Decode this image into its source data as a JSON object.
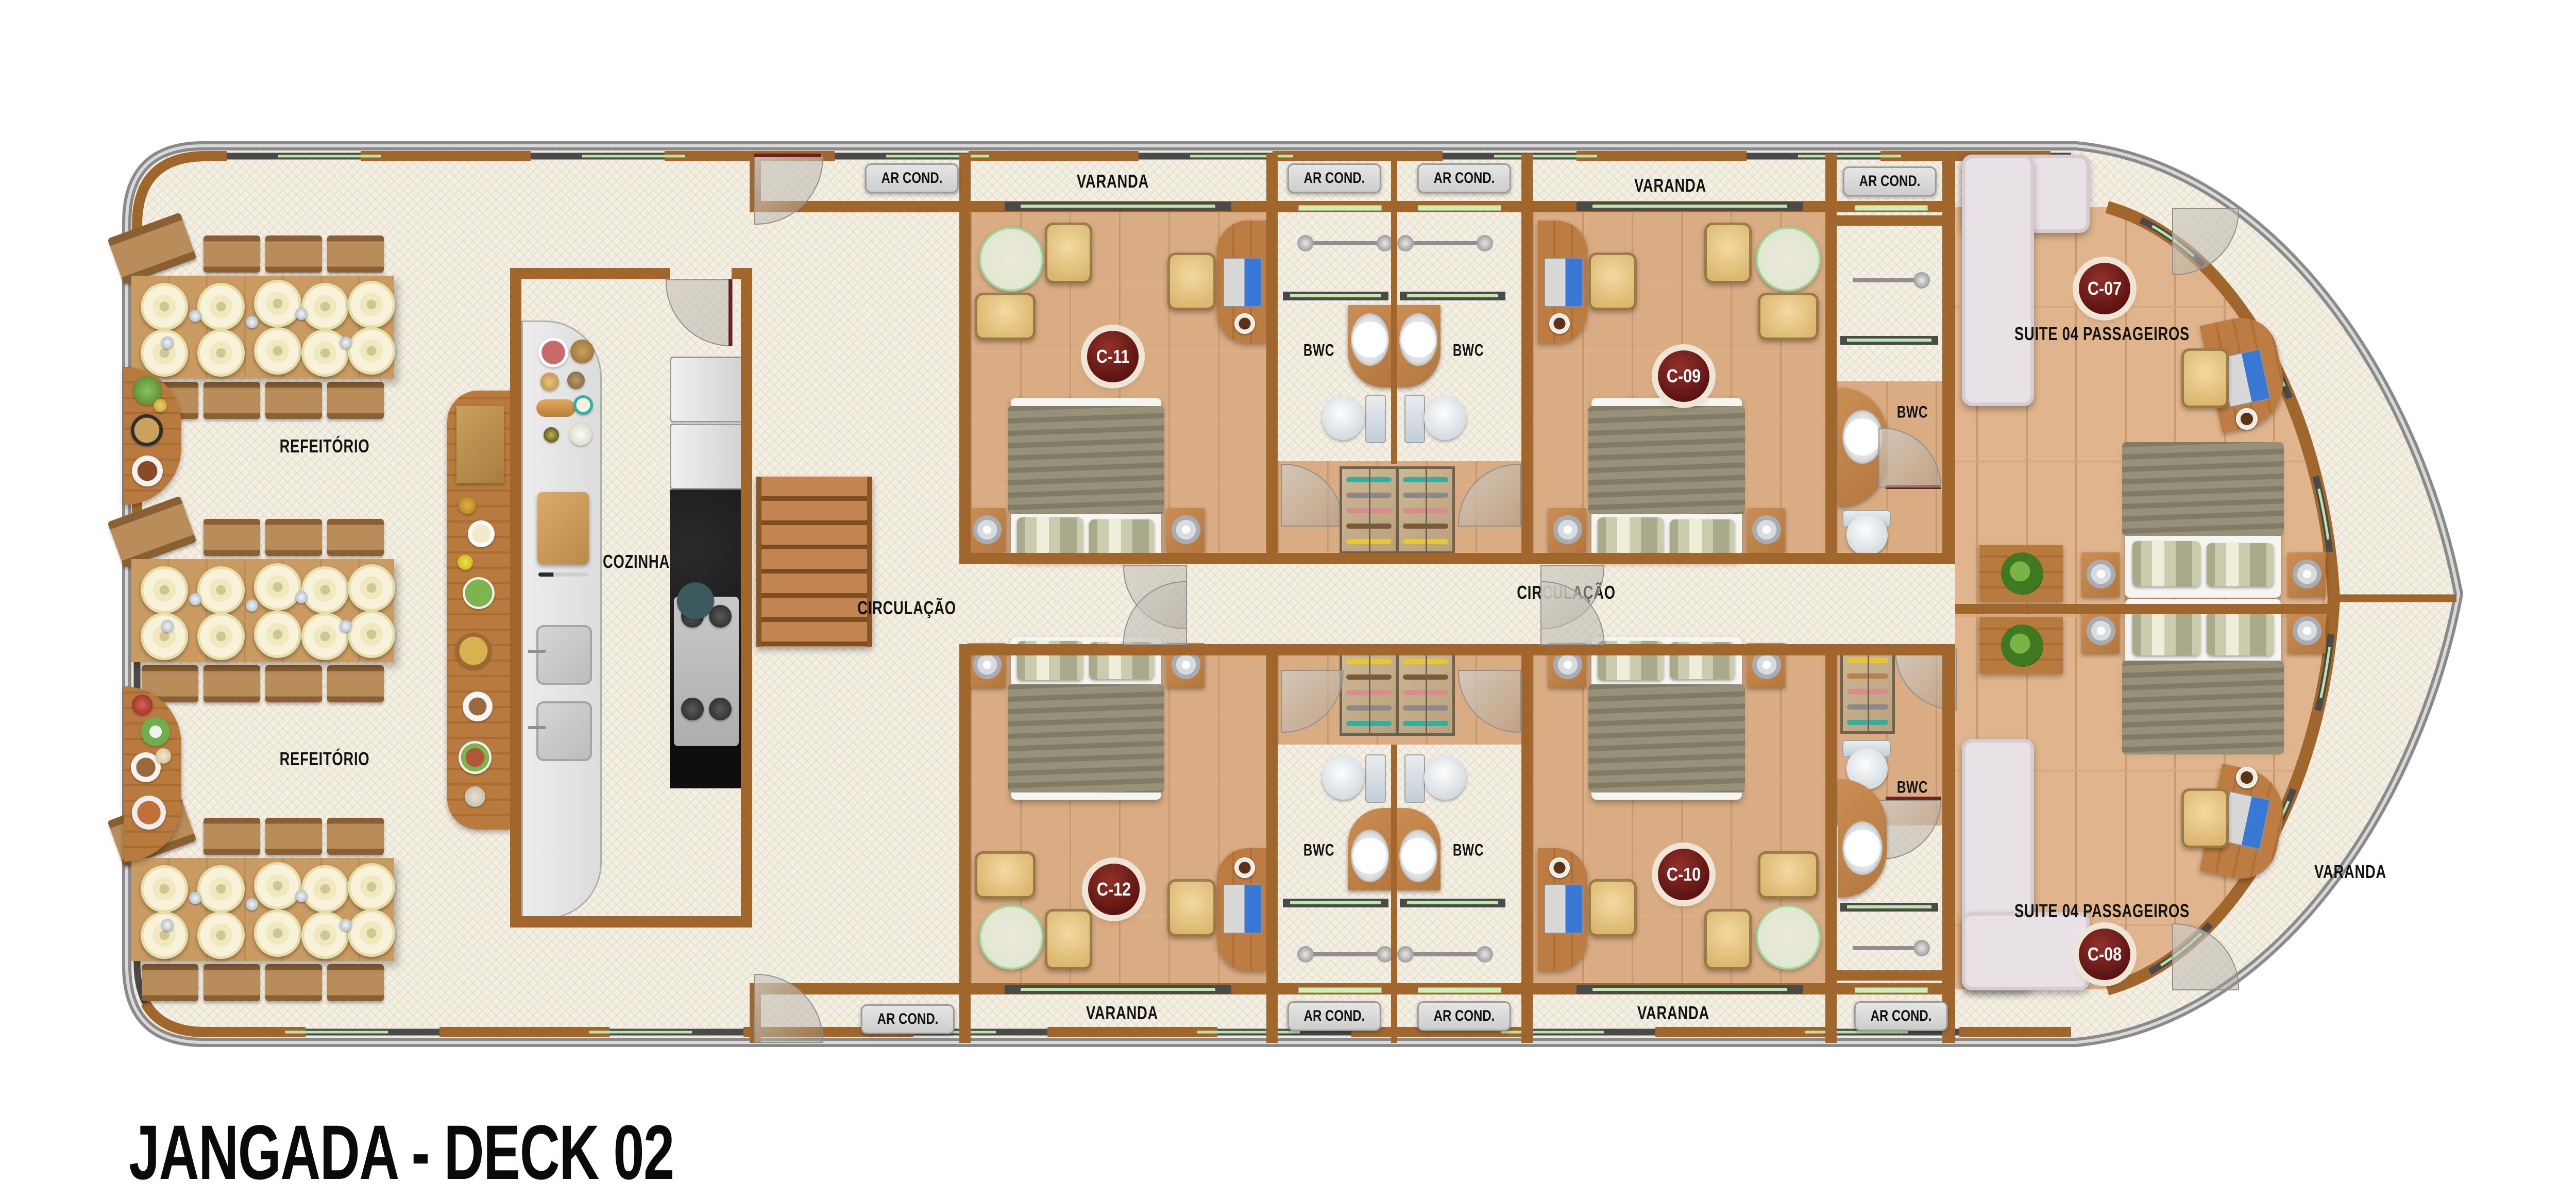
{
  "title": "JANGADA - DECK 02",
  "labels": {
    "varanda": "VARANDA",
    "ar_cond": "AR COND.",
    "bwc": "BWC",
    "refeitorio": "REFEITÓRIO",
    "cozinha": "COZINHA",
    "circulacao": "CIRCULAÇÃO",
    "suite": "SUITE 04 PASSAGEIROS"
  },
  "cabins": [
    {
      "id": "C-11"
    },
    {
      "id": "C-09"
    },
    {
      "id": "C-07"
    },
    {
      "id": "C-12"
    },
    {
      "id": "C-10"
    },
    {
      "id": "C-08"
    }
  ],
  "colors": {
    "wall": "#a0662c",
    "deck": "#f4efe5",
    "cabin_floor": "#d9ac83",
    "suite_floor": "#e0b58d",
    "badge": "#5c1412",
    "window_green": "#bce8aa",
    "hull_gray": "#8a8a8a"
  }
}
